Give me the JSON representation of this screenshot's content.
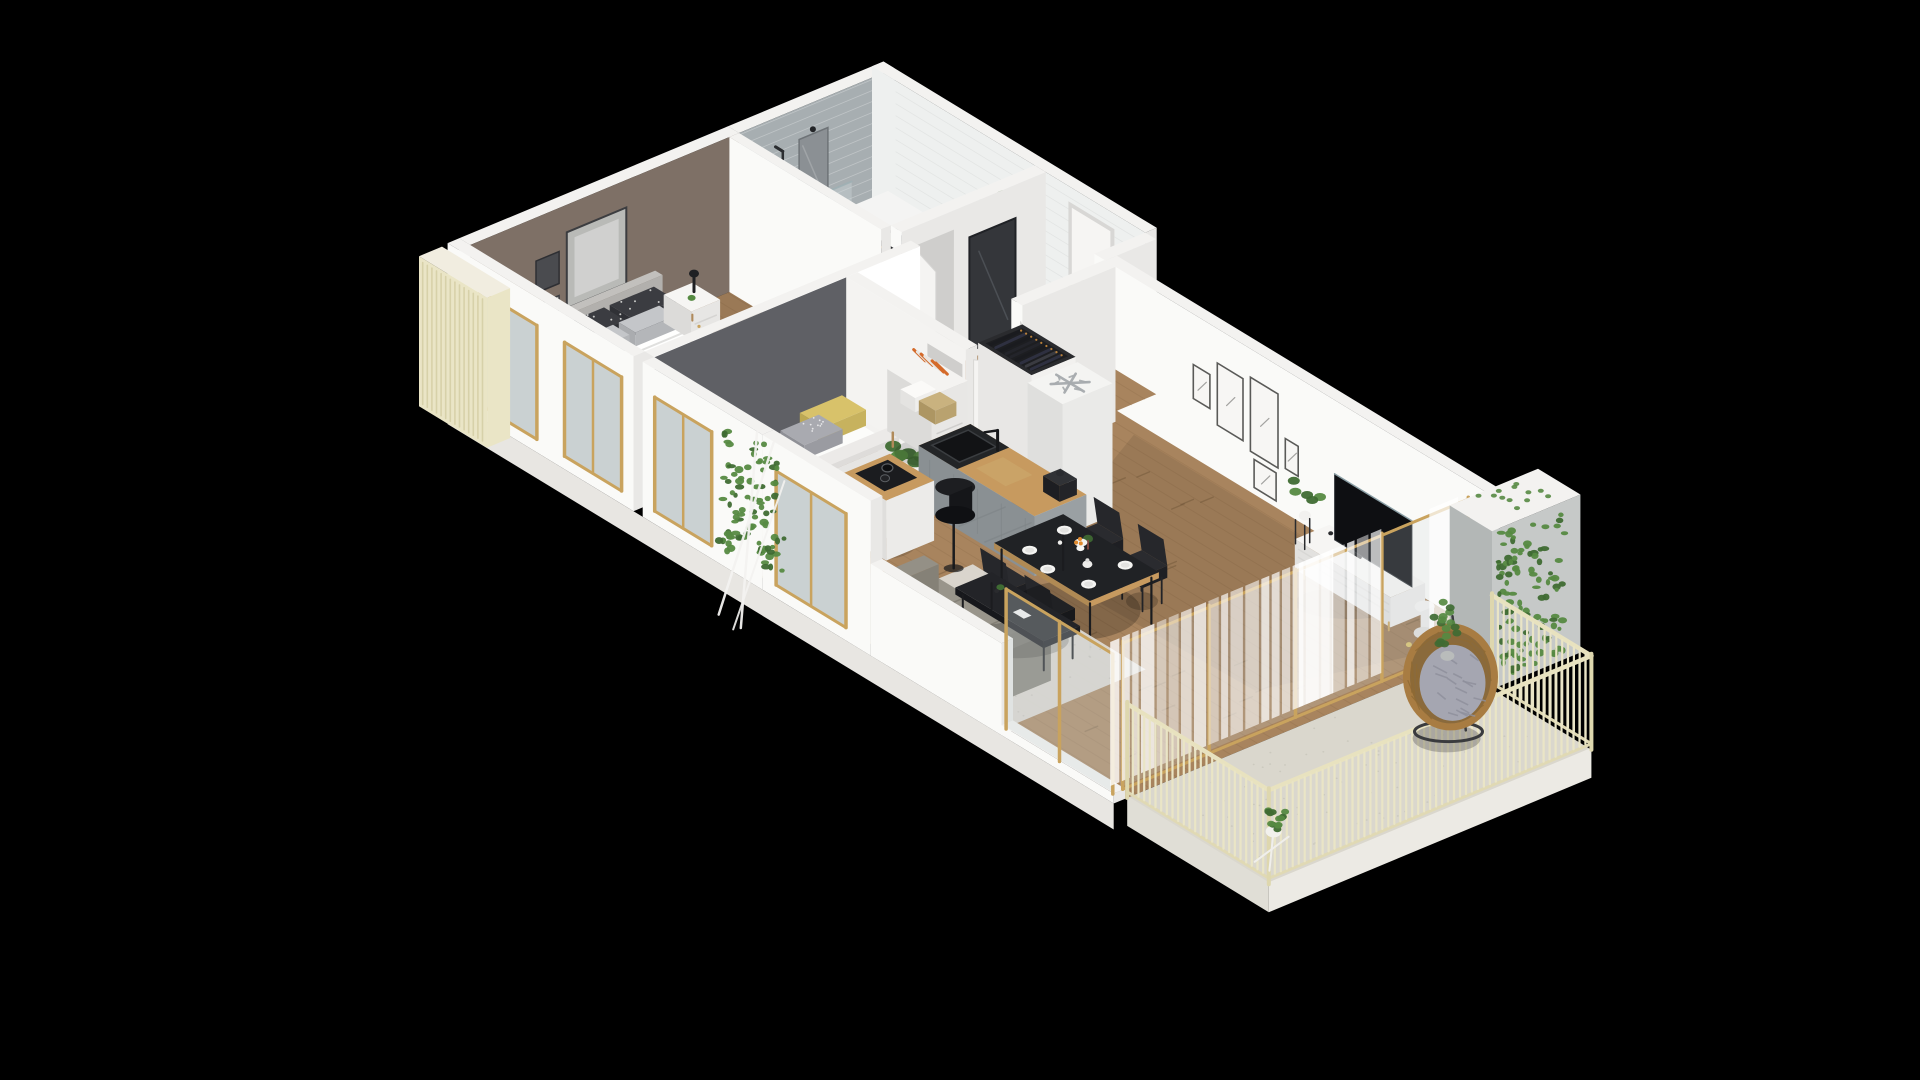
{
  "meta": {
    "description": "3D isometric floor plan rendering of a small apartment shown on a black background",
    "background": "#000000",
    "view": "axonometric bird's eye, walls cut at uniform height"
  },
  "palette": {
    "bg": "#000000",
    "wallTop": "#f3f2f0",
    "wallLight": "#fafaf8",
    "wallMid": "#e9e8e6",
    "wallShade": "#d8d7d5",
    "wallDark": "#c6c5c3",
    "taupeWall": "#7e7066",
    "kidsWall": "#5f6065",
    "grayTile": "#a7aeb1",
    "whiteTile": "#eef0ef",
    "bathFloor": "#e9e7e2",
    "floorPattern": "#565c63",
    "woodFloor": "#a8845e",
    "woodFloorDark": "#8d6c49",
    "oakCounter": "#c79a5f",
    "cabinetGray": "#9aa0a3",
    "cabinetGrayDark": "#8a9093",
    "blackFurniture": "#1d1e21",
    "tvBlack": "#0e0f12",
    "sofaGray": "#908c82",
    "rugLight": "#dcd9d1",
    "cream": "#eae5c6",
    "creamDark": "#d6cfa6",
    "gold": "#c9a35e",
    "greenLeaf": "#568a42",
    "greenDark": "#3f6b33",
    "rattan": "#a87c42",
    "cushionGray": "#a5a6b1",
    "yellowPillow": "#d8c26a",
    "orangeFruit": "#e08a2e",
    "glass": "#cdd8da",
    "curtain": "#ffffff",
    "whiteGoods": "#f1f1ef",
    "mirrorDark": "#34363a",
    "shadow": "#000000"
  },
  "scene": {
    "rooms": [
      {
        "name": "bathroom",
        "features": [
          "gray-subway-tile-wall",
          "white-subway-tile-wall",
          "patterned-tile-floor"
        ],
        "furniture": [
          "bathtub",
          "shower-glass",
          "shower-head",
          "vanity-sink",
          "mirror",
          "wall-sconce",
          "washing-machine",
          "shelf-niche",
          "towels",
          "plant"
        ]
      },
      {
        "name": "master-bedroom",
        "features": [
          "taupe-accent-wall",
          "gallery-frames",
          "wood-floor",
          "gray-rug",
          "gold-frame-windows"
        ],
        "furniture": [
          "double-bed",
          "headboard",
          "patterned-pillows",
          "nightstand",
          "black-table-lamp",
          "small-plant",
          "open-wardrobe-with-clothes",
          "drawer-unit"
        ]
      },
      {
        "name": "kids-room",
        "features": [
          "gray-accent-wall",
          "wood-floor",
          "light-rug",
          "gold-frame-window"
        ],
        "furniture": [
          "single-bed",
          "yellow-pillow",
          "dotted-gray-pillow",
          "monstera-plant",
          "white-desk",
          "white-shell-chair"
        ]
      },
      {
        "name": "hallway",
        "features": [
          "wood-floor"
        ],
        "furniture": [
          "front-door",
          "bathroom-door-ajar",
          "kids-door-ajar",
          "living-door-ajar",
          "dark-mirror-panel",
          "bookshelf-sideboard",
          "books",
          "storage-boxes",
          "wicker-basket"
        ]
      },
      {
        "name": "kitchen",
        "features": [
          "open-plan"
        ],
        "furniture": [
          "coat-wardrobe-open-top",
          "fridge-freezer-snowflake",
          "gray-counter-run",
          "black-sink",
          "black-faucet",
          "coffee-maker",
          "cutting-board",
          "island-with-hob",
          "pots",
          "wood-stool",
          "black-planter"
        ]
      },
      {
        "name": "dining-area",
        "furniture": [
          "black-dining-table",
          "black-chair-1",
          "black-chair-2",
          "black-chair-3",
          "black-chair-4",
          "white-plates",
          "vase-with-flowers",
          "fruit-plate",
          "teapot"
        ]
      },
      {
        "name": "living-room",
        "features": [
          "white-gallery-wall-five-frames",
          "wood-floor",
          "sheer-curtains",
          "gold-frame-glass-wall"
        ],
        "furniture": [
          "tv",
          "white-media-console",
          "plant-on-stand",
          "white-floor-basket",
          "gray-sofa",
          "black-coffee-table",
          "drum-floor-lamp",
          "area-rug",
          "throw-pillows"
        ]
      },
      {
        "name": "balcony",
        "features": [
          "cream-slatted-railing",
          "concrete-floor",
          "ivy-covered-side-wall"
        ],
        "furniture": [
          "hanging-egg-chair",
          "gray-tufted-cushion",
          "potted-plant-on-stand",
          "small-potted-tree"
        ]
      }
    ],
    "exterior": [
      "white-cut-walls",
      "cream-slat-privacy-screen",
      "hanging-ivy-over-wall",
      "white-drying-frame"
    ]
  }
}
